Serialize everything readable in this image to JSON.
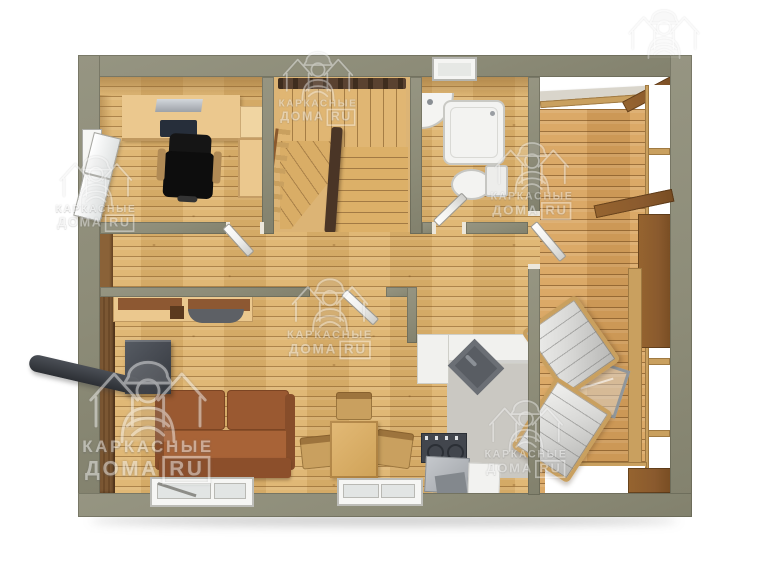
{
  "meta": {
    "description": "3D top-down architectural floor plan render of a single-storey frame house with terrace",
    "language": "ru"
  },
  "watermark": {
    "line1": "КАРКАСНЫЕ",
    "line2": "ДОМА",
    "badge": "RU",
    "instances": [
      {
        "x": 318,
        "y": 44,
        "scale": 0.78,
        "opacity": 0.5,
        "show_text": true
      },
      {
        "x": 96,
        "y": 148,
        "scale": 0.8,
        "opacity": 0.5,
        "show_text": true
      },
      {
        "x": 330,
        "y": 270,
        "scale": 0.85,
        "opacity": 0.5,
        "show_text": true
      },
      {
        "x": 148,
        "y": 348,
        "scale": 1.3,
        "opacity": 0.55,
        "show_text": true
      },
      {
        "x": 532,
        "y": 134,
        "scale": 0.82,
        "opacity": 0.5,
        "show_text": true
      },
      {
        "x": 526,
        "y": 392,
        "scale": 0.82,
        "opacity": 0.5,
        "show_text": true
      },
      {
        "x": 664,
        "y": 2,
        "scale": 0.78,
        "opacity": 0.4,
        "show_text": false
      }
    ]
  },
  "colors": {
    "wall": "#8d8c78",
    "floor_base": "#dcb16c",
    "terrace_base": "#d7a15c",
    "trim_tan": "#c9a05f",
    "beam_brown": "#8a5a2e",
    "railing_brown": "#4a3526",
    "sofa_brown": "#9a5931",
    "stove_gray": "#42464d",
    "tile_gray": "#cac8c2",
    "fixture_white": "#f3f3f1",
    "metal_gray": "#8f969b",
    "cabinet_inset": "#8d5832",
    "desk_tan": "#ebc88e",
    "door_white": "#f0f0ee",
    "wm_color": "rgba(252,252,252,0.85)"
  }
}
